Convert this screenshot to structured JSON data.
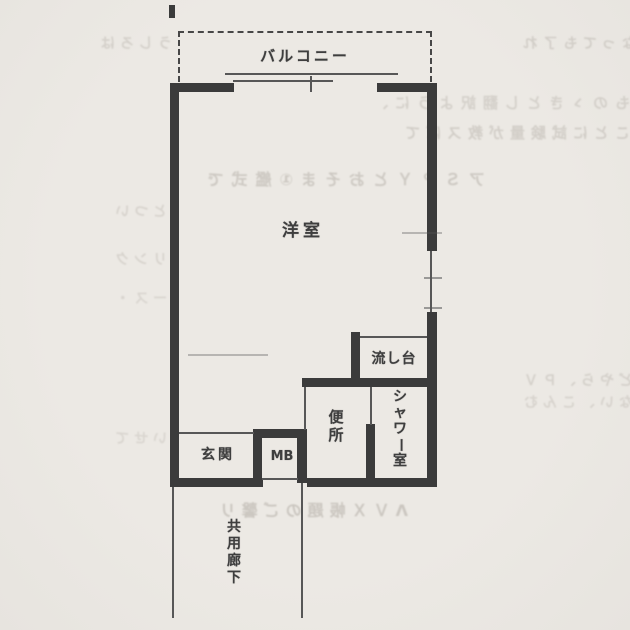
{
  "page": {
    "background": "#ece9e4",
    "wall_color": "#3b3b3b",
    "thin_line_color": "#575757",
    "text_color": "#3e3e3e"
  },
  "floor_plan": {
    "balcony_label": "バルコニー",
    "main_room_label": "洋室",
    "sink_label": "流し台",
    "shower_label": "シャワー室",
    "toilet_label": "便所",
    "entrance_label": "玄関",
    "meter_box_label": "MB",
    "corridor_label": "共用廊下"
  },
  "bleed_through": {
    "rows": [
      "なっても了れ",
      "うしろは",
      "ものゝきとし翻訳ように、",
      "ことに試験量が教スぼて",
      "アＳＰＹとおそま①艦式で",
      "とつい",
      "リンク",
      "ース・",
      "どやら、ＰＶ",
      "ない、こんむ",
      "いせて",
      "ΛＶＸ帳題のご馨リ"
    ]
  }
}
